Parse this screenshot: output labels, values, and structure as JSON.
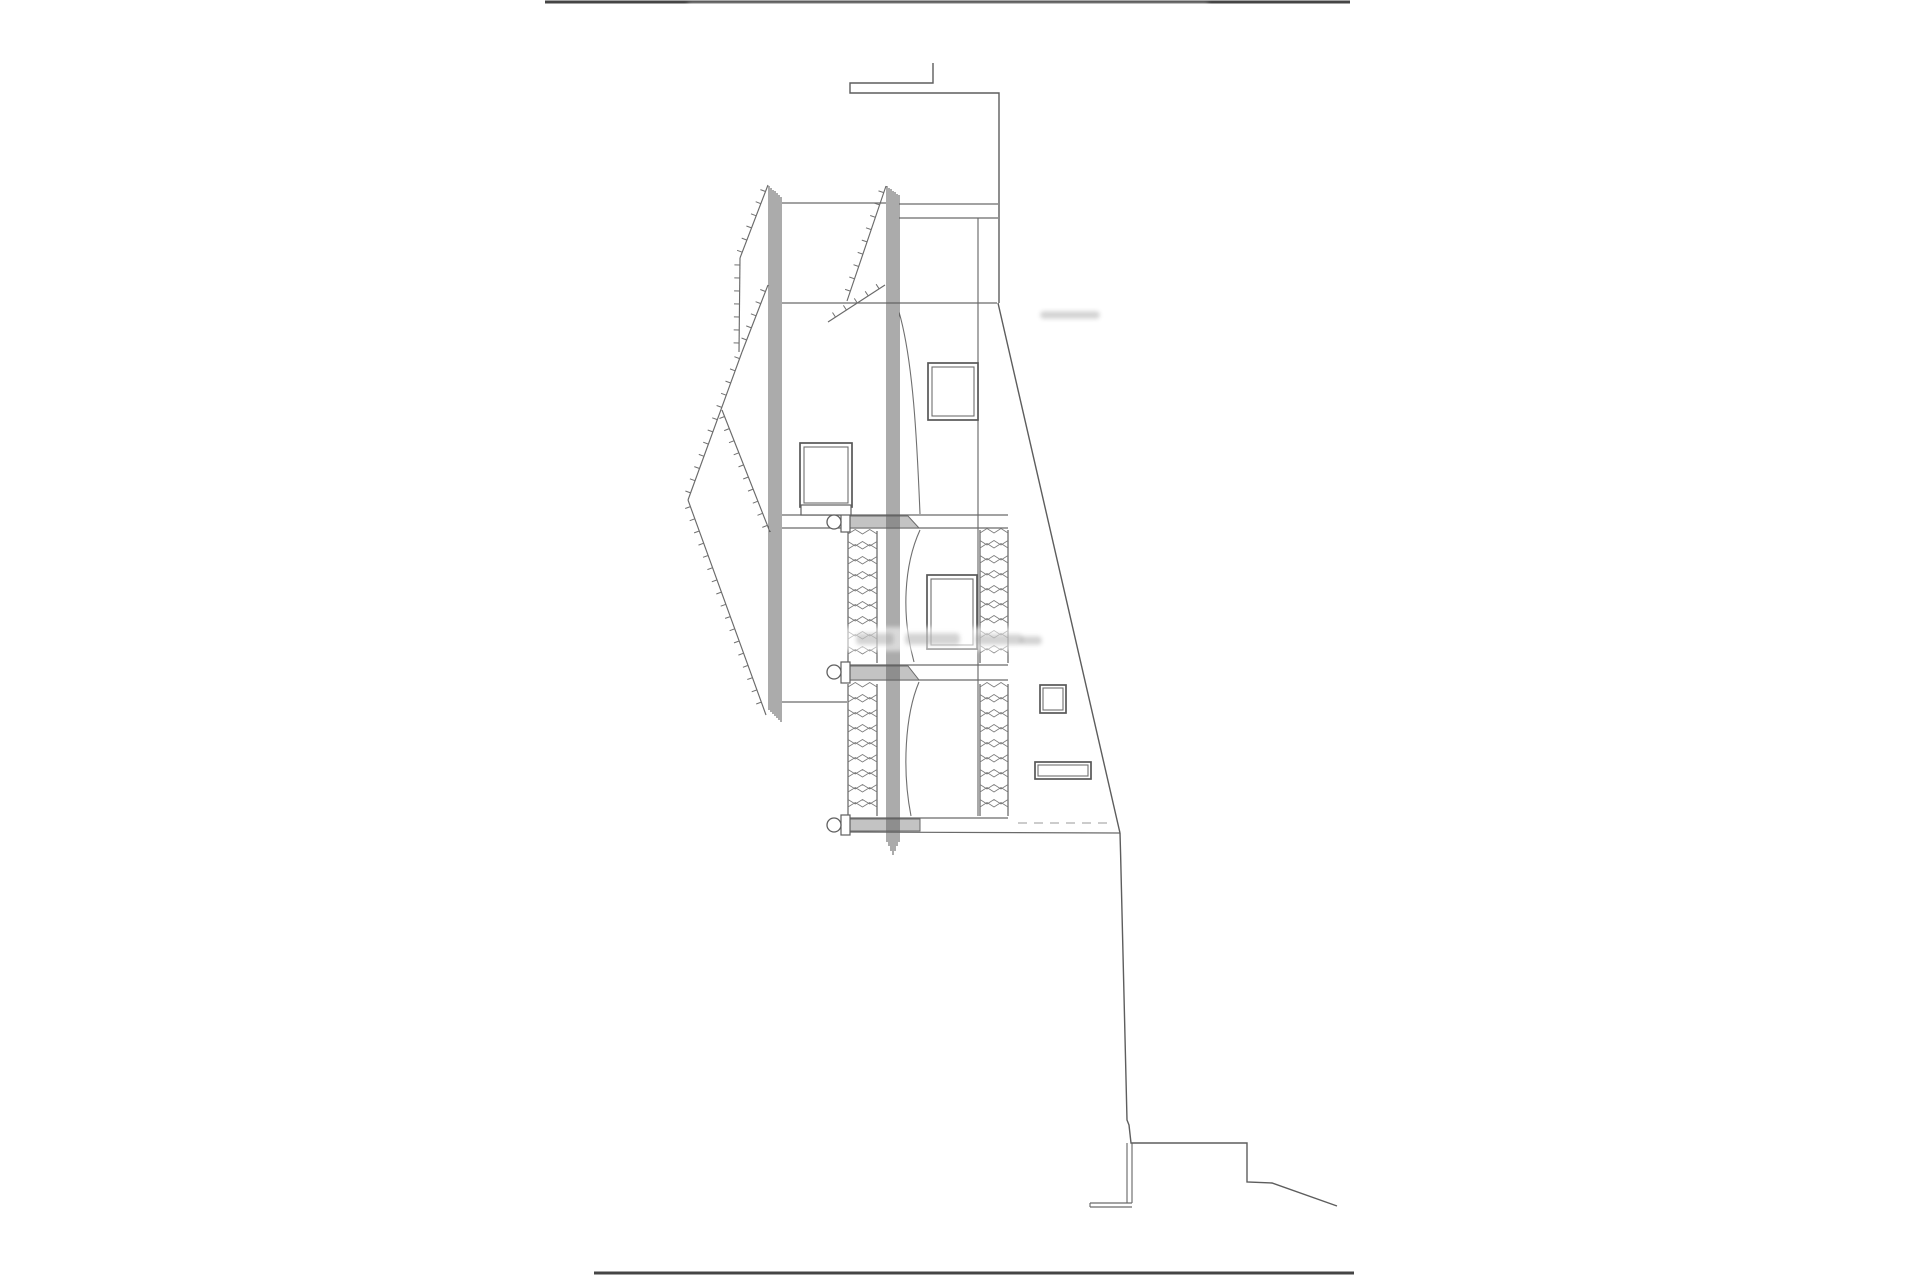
{
  "canvas": {
    "w": 1920,
    "h": 1280,
    "background": "#ffffff",
    "ink": "#6a6a6a"
  },
  "drawing": {
    "border_lines": [
      {
        "x1": 545,
        "y1": 2,
        "x2": 1350,
        "y2": 2,
        "name": "sheet-top-edge"
      },
      {
        "x1": 594,
        "y1": 1273,
        "x2": 1354,
        "y2": 1273,
        "name": "sheet-bottom-edge"
      }
    ],
    "lines": [
      [
        899,
        204,
        998,
        204
      ],
      [
        899,
        218,
        998,
        218
      ],
      [
        782,
        203,
        886,
        203
      ],
      [
        782,
        303,
        997,
        303
      ],
      [
        978,
        218,
        978,
        816
      ],
      [
        782,
        702,
        847,
        702
      ],
      [
        782,
        515,
        1008,
        515
      ],
      [
        782,
        528,
        1008,
        528
      ],
      [
        842,
        665,
        1008,
        665
      ],
      [
        842,
        680,
        1008,
        680
      ],
      [
        842,
        818,
        1008,
        818
      ],
      [
        842,
        832,
        1120,
        833
      ],
      [
        1127,
        1143,
        1127,
        1203
      ],
      [
        1132,
        1143,
        1132,
        1203
      ],
      [
        1090,
        1203,
        1132,
        1203
      ],
      [
        1090,
        1207,
        1132,
        1207
      ],
      [
        1090,
        1203,
        1090,
        1207
      ]
    ],
    "dashed_lines": [
      [
        1018,
        823,
        1112,
        823
      ]
    ],
    "paths": [
      {
        "d": "M 933 63 L 933 83 L 850 83 L 850 93 L 999 93 L 999 303",
        "name": "parapet-step-outline"
      },
      {
        "d": "M 998 303 L 1120 833",
        "name": "right-wall-slope"
      },
      {
        "d": "M 1120 833 C 1123 940 1126 1050 1127 1120 L 1129 1125 L 1131 1143 L 1247 1143 L 1247 1182 L 1272 1183 L 1337 1206",
        "name": "terrain-profile"
      }
    ],
    "curves": [
      {
        "d": "M 899 312 C 913 360 917 440 920 514",
        "name": "brace-curve-upper"
      },
      {
        "d": "M 920 530 C 904 565 901 615 914 662",
        "name": "brace-curve-middle"
      },
      {
        "d": "M 919 682 C 905 715 902 770 911 816",
        "name": "brace-curve-lower"
      }
    ],
    "tick_lines": [
      [
        768,
        185,
        740,
        258
      ],
      [
        740,
        258,
        739,
        352
      ],
      [
        768,
        285,
        742,
        352
      ],
      [
        742,
        352,
        688,
        500
      ],
      [
        722,
        410,
        770,
        532
      ],
      [
        688,
        500,
        766,
        715
      ],
      [
        886,
        186,
        847,
        301
      ],
      [
        885,
        285,
        828,
        322
      ]
    ],
    "columns": [
      {
        "name": "left-laminated-post",
        "lines": [
          [
            769,
            186,
            710
          ],
          [
            771,
            188,
            712
          ],
          [
            773,
            190,
            714
          ],
          [
            775,
            191,
            716
          ],
          [
            777,
            193,
            718
          ],
          [
            779,
            195,
            720
          ],
          [
            781,
            197,
            722
          ]
        ]
      },
      {
        "name": "right-laminated-post",
        "lines": [
          [
            887,
            186,
            842
          ],
          [
            889,
            188,
            846
          ],
          [
            891,
            189,
            851
          ],
          [
            893,
            191,
            855
          ],
          [
            895,
            192,
            851
          ],
          [
            897,
            194,
            846
          ],
          [
            899,
            195,
            842
          ]
        ]
      }
    ],
    "windows": [
      {
        "x": 928,
        "y": 363,
        "w": 50,
        "h": 57,
        "inset": 4,
        "name": "upper-window"
      },
      {
        "x": 800,
        "y": 443,
        "w": 52,
        "h": 64,
        "inset": 4,
        "name": "mid-window"
      },
      {
        "x": 927,
        "y": 575,
        "w": 50,
        "h": 74,
        "inset": 4,
        "name": "lower-window"
      },
      {
        "x": 1040,
        "y": 685,
        "w": 26,
        "h": 28,
        "inset": 3,
        "name": "small-square-window"
      },
      {
        "x": 1035,
        "y": 762,
        "w": 56,
        "h": 17,
        "inset": 3,
        "name": "slot-window"
      }
    ],
    "blocks": [
      [
        841,
        512,
        9,
        20
      ],
      [
        841,
        662,
        9,
        21
      ],
      [
        841,
        815,
        9,
        20
      ],
      [
        801,
        505,
        50,
        10
      ]
    ],
    "beams": [
      "850,516 908,516 919,528 850,528",
      "850,666 908,666 919,680 850,680",
      "850,819 920,819 920,831 850,831"
    ],
    "bolts": [
      [
        834,
        522,
        7
      ],
      [
        834,
        672,
        7
      ],
      [
        834,
        825,
        7
      ]
    ],
    "panels": [
      {
        "x": 848,
        "y": 531,
        "w": 29,
        "h": 132
      },
      {
        "x": 848,
        "y": 684,
        "w": 29,
        "h": 132
      },
      {
        "x": 980,
        "y": 530,
        "w": 28,
        "h": 133
      },
      {
        "x": 980,
        "y": 684,
        "w": 28,
        "h": 132
      }
    ],
    "washes": [
      {
        "x": 842,
        "y": 627,
        "w": 202,
        "h": 24,
        "o": 0.55
      },
      {
        "x": 1012,
        "y": 309,
        "w": 130,
        "h": 13,
        "o": 0.4
      },
      {
        "x": 688,
        "y": 3,
        "w": 520,
        "h": 6,
        "o": 0.3
      }
    ],
    "blobs": [
      {
        "x": 856,
        "y": 633,
        "w": 38,
        "h": 12
      },
      {
        "x": 905,
        "y": 633,
        "w": 55,
        "h": 12
      },
      {
        "x": 975,
        "y": 634,
        "w": 48,
        "h": 11
      },
      {
        "x": 1020,
        "y": 636,
        "w": 22,
        "h": 9
      },
      {
        "x": 1040,
        "y": 311,
        "w": 60,
        "h": 8
      }
    ],
    "tick_spacing": 13,
    "tick_length": 5.5
  }
}
